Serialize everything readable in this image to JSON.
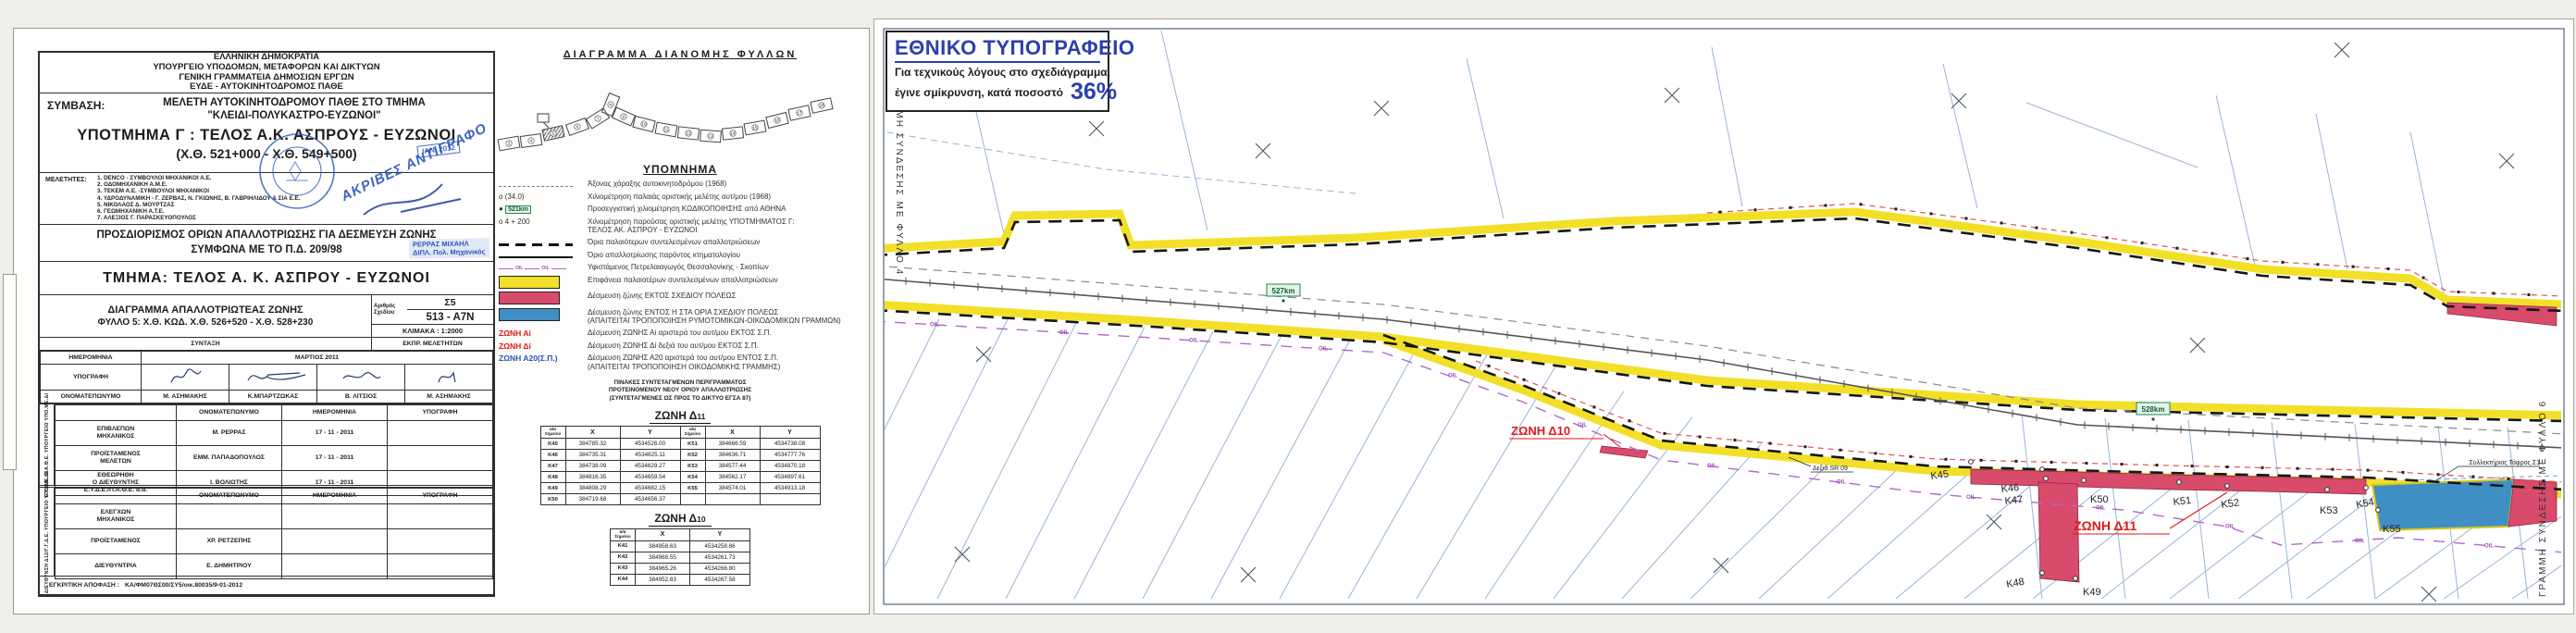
{
  "colors": {
    "yellow": "#f2e028",
    "red_zone": "#d84b6b",
    "blue_zone": "#3f8fc5",
    "oil_purple": "#b168c9",
    "red_label": "#e01818",
    "stamp_blue": "#2b55b8",
    "km_green": "#1d8a52"
  },
  "left": {
    "agency_lines": [
      "ΕΛΛΗΝΙΚΗ ΔΗΜΟΚΡΑΤΙΑ",
      "ΥΠΟΥΡΓΕΙΟ ΥΠΟΔΟΜΩΝ, ΜΕΤΑΦΟΡΩΝ ΚΑΙ ΔΙΚΤΥΩΝ",
      "ΓΕΝΙΚΗ ΓΡΑΜΜΑΤΕΙΑ ΔΗΜΟΣΙΩΝ ΕΡΓΩΝ",
      "ΕΥΔΕ - ΑΥΤΟΚΙΝΗΤΟΔΡΟΜΟΣ ΠΑΘΕ"
    ],
    "symvasi_label": "ΣΥΜΒΑΣΗ:",
    "symvasi_lines": [
      "ΜΕΛΕΤΗ ΑΥΤΟΚΙΝΗΤΟΔΡΟΜΟΥ ΠΑΘΕ ΣΤΟ ΤΜΗΜΑ",
      "\"ΚΛΕΙΔΙ-ΠΟΛΥΚΑΣΤΡΟ-ΕΥΖΩΝΟΙ\""
    ],
    "ypotmima": "ΥΠΟΤΜΗΜΑ Γ : ΤΕΛΟΣ Α.Κ. ΑΣΠΡΟΥΣ - ΕΥΖΩΝΟΙ",
    "chainage": "(Χ.Θ. 521+000 - Χ.Θ. 549+500)",
    "meletites_label": "ΜΕΛΕΤΗΤΕΣ:",
    "meletites": [
      "1. DENCO - ΣΥΜΒΟΥΛΟΙ ΜΗΧΑΝΙΚΟΙ Α.Ε.",
      "2. ΟΔΟΜΗΧΑΝΙΚΗ Α.Μ.Ε.",
      "3. ΤΕΚΕΜ Α.Ε. -ΣΥΜΒΟΥΛΟΙ ΜΗΧΑΝΙΚΟΙ",
      "4. ΥΔΡΟΔΥΝΑΜΙΚΗ - Γ. ΖΕΡΒΑΣ, Ν. ΓΚΙΩΝΗΣ, Β. ΓΑΒΡΙΗΛΙΔΟΥ & ΣΙΑ Ε.Ε.",
      "5. ΝΙΚΟΛΑΟΣ Δ. ΜΟΥΡΤΖΑΣ",
      "6. ΓΕΩΜΗΧΑΝΙΚΗ Α.Τ.Ε.",
      "7. ΑΛΕΞΙΟΣ Γ. ΠΑΡΑΣΚΕΥΟΠΟΥΛΟΣ"
    ],
    "stamp_copy": "ΑΚΡΙΒΕΣ ΑΝΤΙΓΡΑΦΟ",
    "stamp_date": "ΙΑΝ. 2012",
    "prosdiorismos_lines": [
      "ΠΡΟΣΔΙΟΡΙΣΜΟΣ ΟΡΙΩΝ ΑΠΑΛΛΟΤΡΙΩΣΗΣ ΓΙΑ ΔΕΣΜΕΥΣΗ ΖΩΝΗΣ",
      "ΣΥΜΦΩΝΑ ΜΕ ΤΟ Π.Δ. 209/98"
    ],
    "stamp_name": "ΡΕΡΡΑΣ ΜΙΧΑΗΛ",
    "stamp_name2": "ΔΙΠΛ. Πολ. Μηχανικός",
    "tmima": "ΤΜΗΜΑ: ΤΕΛΟΣ  Α. Κ. ΑΣΠΡΟΥ - ΕΥΖΩΝΟΙ",
    "diagramma_lines": [
      "ΔΙΑΓΡΑΜΜΑ ΑΠΑΛΛΟΤΡΙΩΤΕΑΣ ΖΩΝΗΣ",
      "ΦΥΛΛΟ  5: Χ.Θ. ΚΩΔ. Χ.Θ. 526+520 - Χ.Θ. 528+230"
    ],
    "arithmos_label": "Αριθμός\nΣχεδίου",
    "arithmos_top": "Σ5",
    "arithmos_bottom": "513 - Α7Ν",
    "klimaka": "ΚΛΙΜΑΚΑ :  1:2000",
    "syntaxi": "ΣΥΝΤΑΞΗ",
    "ekpr": "ΕΚΠΡ. ΜΕΛΕΤΗΤΩΝ",
    "row_date_label": "ΗΜΕΡΟΜΗΝΙΑ",
    "row_date_value": "ΜΑΡΤΙΟΣ  2011",
    "row_sign_label": "ΥΠΟΓΡΑΦΗ",
    "row_name_label": "ΟΝΟΜΑΤΕΠΩΝΥΜΟ",
    "syntaxi_names": [
      "Μ. ΑΣΗΜΑΚΗΣ",
      "Κ.ΜΠΑΡΤΖΩΚΑΣ",
      "Β. ΛΙΤΣΙΟΣ",
      "Μ. ΑΣΗΜΑΚΗΣ"
    ],
    "eyde_side": "Ε.Υ.Δ.Ε./Π.Α.Θ.Ε. ΥΠΟΥΡΓΕΙΟ ΥΠΟ.ΜΕ.ΔΙ",
    "col_onoma": "ΟΝΟΜΑΤΕΠΩΝΥΜΟ",
    "col_date": "ΗΜΕΡΟΜΗΝΙΑ",
    "col_sign": "ΥΠΟΓΡΑΦΗ",
    "eyde_rows": [
      [
        "ΕΠΙΒΛΕΠΩΝ\nΜΗΧΑΝΙΚΟΣ",
        "Μ. ΡΕΡΡΑΣ",
        "17 - 11 - 2011",
        ""
      ],
      [
        "ΠΡΟΪΣΤΑΜΕΝΟΣ\nΜΕΛΕΤΩΝ",
        "ΕΜΜ. ΠΑΠΑΔΟΠΟΥΛΟΣ",
        "17 - 11 - 2011",
        ""
      ],
      [
        "ΕΘΕΩΡΗΘΗ\nΟ ΔΙΕΥΘΥΝΤΗΣ\nΕ.Υ.Δ.Ε./Π.Α.Θ.Ε. α.α.",
        "Ι. ΒΟΛΙΩΤΗΣ",
        "17 - 11 - 2011",
        ""
      ]
    ],
    "d12_side": "ΔΙΕΥΘΥΝΣΗ Δ12/Γ.Γ.Δ.Ε. ΥΠΟΥΡΓΕΙΟ ΥΠΟ.ΜΕ.ΔΙ",
    "d12_rows": [
      [
        "ΕΛΕΓΧΩΝ\nΜΗΧΑΝΙΚΟΣ",
        "",
        "",
        ""
      ],
      [
        "ΠΡΟΪΣΤΑΜΕΝΟΣ",
        "ΧΡ. ΡΕΤΖΕΠΗΣ",
        "",
        ""
      ],
      [
        "ΔΙΕΥΘΥΝΤΡΙΑ",
        "Ε. ΔΗΜΗΤΡΙΟΥ",
        "",
        ""
      ]
    ],
    "egkritiki_label": "ΕΓΚΡΙΤΙΚΗ ΑΠΟΦΑΣΗ :",
    "egkritiki_value": "ΚΑ/ΦΜ07ΘΣ00/ΣΥ5/οικ.80035/9-01-2012"
  },
  "middle": {
    "diagram_title": "ΔΙΑΓΡΑΜΜΑ  ΔΙΑΝΟΜΗΣ  ΦΥΛΛΩΝ",
    "sheets": [
      "3",
      "4",
      "5",
      "6",
      "7",
      "8",
      "9",
      "10",
      "11",
      "12",
      "13",
      "14",
      "15",
      "16",
      "17",
      "18"
    ],
    "current_sheet": "5",
    "ypomnima_title": "ΥΠΟΜΝΗΜΑ",
    "legend": [
      {
        "marker": "",
        "label": "Άξονας χάραξης αυτοκινητοδρόμου (1968)"
      },
      {
        "marker": "o  (34.0)",
        "label": "Χιλιομέτρηση παλαιάς οριστικής μελέτης αυτ/μου (1968)"
      },
      {
        "marker": "521km",
        "label": "Προσεγγιστική χιλιομέτρηση ΚΩΔΙΚΟΠΟΙΗΣΗΣ από ΑΘΗΝΑ"
      },
      {
        "marker": "o 4 + 200",
        "label": "Χιλιομέτρηση παρούσας οριστικής μελέτης ΥΠΟΤΜΗΜΑΤΟΣ Γ:",
        "label2": "ΤΕΛΟΣ ΑΚ. ΑΣΠΡΟΥ - ΕΥΖΩΝΟΙ"
      },
      {
        "label": "Όρια παλαιότερων συντελεσμένων απαλλοτριώσεων"
      },
      {
        "label": "Όριο απαλλοτρίωσης παρόντος κτηματολογίου"
      },
      {
        "label": "Υφιστάμενος Πετρελαιαγωγός  Θεσσαλονίκης - Σκοπίων"
      },
      {
        "label": "Επιφάνεια παλαιοτέρων συντελεσμένων απαλλοτριώσεων"
      },
      {
        "label": "Δέσμευση ζώνης ΕΚΤΟΣ ΣΧΕΔΙΟΥ ΠΟΛΕΩΣ"
      },
      {
        "label": "Δέσμευση ζώνης ΕΝΤΟΣ Η ΣΤΑ ΟΡΙΑ ΣΧΕΔΙΟΥ ΠΟΛΕΩΣ",
        "label2": "(ΑΠΑΙΤΕΙΤΑΙ ΤΡΟΠΟΠΟΙΗΣΗ ΡΥΜΟΤΟΜΙΚΩΝ-ΟΙΚΟΔΟΜΙΚΩΝ ΓΡΑΜΜΩΝ)"
      },
      {
        "marker": "ΖΩΝΗ Αi",
        "label": "Δέσμευση ΖΩΝΗΣ  Αi  αριστερά του αυτ/μου ΕΚΤΟΣ Σ.Π."
      },
      {
        "marker": "ΖΩΝΗ Δi",
        "label": "Δέσμευση ΖΩΝΗΣ  Δi  δεξιά του αυτ/μου ΕΚΤΟΣ Σ.Π."
      },
      {
        "marker": "ΖΩΝΗ Α20(Σ.Π.)",
        "label": "Δέσμευση ΖΩΝΗΣ  Α20  αριστερά του αυτ/μου ΕΝΤΟΣ Σ.Π.",
        "label2": "(ΑΠΑΙΤΕΙΤΑΙ ΤΡΟΠΟΠΟΙΗΣΗ ΟΙΚΟΔΟΜΙΚΗΣ ΓΡΑΜΜΗΣ)"
      }
    ],
    "tables_note": [
      "ΠΙΝΑΚΕΣ ΣΥΝΤΕΤΑΓΜΕΝΩΝ ΠΕΡΙΓΡΑΜΜΑΤΟΣ",
      "ΠΡΟΤΕΙΝΟΜΕΝΟΥ ΝΕΟΥ ΟΡΙΟΥ ΑΠΑΛΛΟΤΡΙΩΣΗΣ",
      "(ΣΥΝΤΕΤΑΓΜΕΝΕΣ ΩΣ ΠΡΟΣ ΤΟ ΔΙΚΤΥΟ ΕΓΣΑ 87)"
    ],
    "zone11_prefix": "ΖΩΝΗ  Δ",
    "zone11_num": "11",
    "zone10_prefix": "ΖΩΝΗ  Δ",
    "zone10_num": "10",
    "col_pt": "α/α\nΣημείου",
    "col_x": "X",
    "col_y": "Y",
    "d11_rows": [
      [
        "Κ45",
        "384785.32",
        "4534526.00",
        "Κ51",
        "384666.59",
        "4534738.08"
      ],
      [
        "Κ46",
        "384735.31",
        "4534625.11",
        "Κ52",
        "384636.71",
        "4534777.76"
      ],
      [
        "Κ47",
        "384738.09",
        "4534629.27",
        "Κ53",
        "384577.44",
        "4534870.18"
      ],
      [
        "Κ48",
        "384816.35",
        "4534659.54",
        "Κ54",
        "384562.17",
        "4534897.61"
      ],
      [
        "Κ49",
        "384808.29",
        "4534682.15",
        "Κ55",
        "384574.01",
        "4534913.18"
      ],
      [
        "Κ50",
        "384719.68",
        "4534656.37",
        "",
        "",
        ""
      ]
    ],
    "d10_rows": [
      [
        "Κ41",
        "384958.63",
        "4534258.86"
      ],
      [
        "Κ42",
        "384968.55",
        "4534261.73"
      ],
      [
        "Κ43",
        "384965.26",
        "4534266.80"
      ],
      [
        "Κ44",
        "384952.83",
        "4534267.58"
      ]
    ]
  },
  "map": {
    "press_title": "ΕΘΝΙΚΟ ΤΥΠΟΓΡΑΦΕΙΟ",
    "press_line1": "Για τεχνικούς λόγους στο σχεδιάγραμμα,",
    "press_line2": "έγινε σμίκρυνση, κατά ποσοστό",
    "press_pct": "36%",
    "edge_left": "ΓΡΑΜΜΗ ΣΥΝΔΕΣΗΣ ΜΕ ΦΥΛΛΟ 4",
    "edge_right": "ΓΡΑΜΜΗ ΣΥΝΔΕΣΗΣ ΜΕ ΦΥΛΛΟ 6",
    "zone_d11": "ΖΩΝΗ  Δ11",
    "zone_d10": "ΖΩΝΗ  Δ10",
    "km527": "527km",
    "km528": "528km",
    "oil": "OIL",
    "label_sr": "Δεξιά SR 09",
    "label_ditch": "Συλλεκτήριος Τάφρος Σ1",
    "points": [
      "Κ45",
      "Κ46",
      "Κ47",
      "Κ48",
      "Κ49",
      "Κ50",
      "Κ51",
      "Κ52",
      "Κ53",
      "Κ54",
      "Κ55"
    ]
  }
}
